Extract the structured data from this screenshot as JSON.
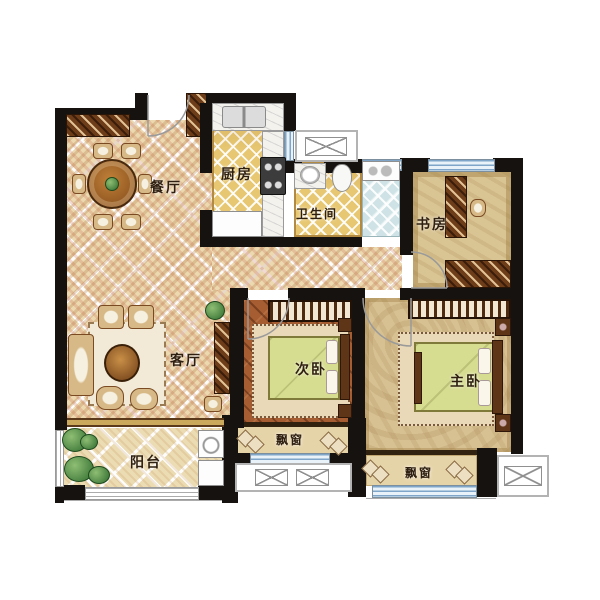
{
  "floorplan": {
    "type": "residential-apartment-floor-plan",
    "rooms": {
      "dining": {
        "label": "餐厅"
      },
      "kitchen": {
        "label": "厨房"
      },
      "bathroom": {
        "label": "卫生间"
      },
      "study": {
        "label": "书房"
      },
      "living": {
        "label": "客厅"
      },
      "bedroom_second": {
        "label": "次卧"
      },
      "bedroom_master": {
        "label": "主卧"
      },
      "balcony": {
        "label": "阳台"
      },
      "bay_window_second": {
        "label": "飘窗"
      },
      "bay_window_master": {
        "label": "飘窗"
      }
    },
    "colors": {
      "wall": "#161210",
      "main_floor": "#ecd9b0",
      "kitchen_tile": "#e7c772",
      "shower_tile": "#cfe3e6",
      "bedroom_wood": "#a55d31",
      "study_floor": "#d9c493",
      "window_glass": "#7fa6c8",
      "bed_blanket": "#d6dc90",
      "furniture_wood": "#6d3c18"
    }
  }
}
